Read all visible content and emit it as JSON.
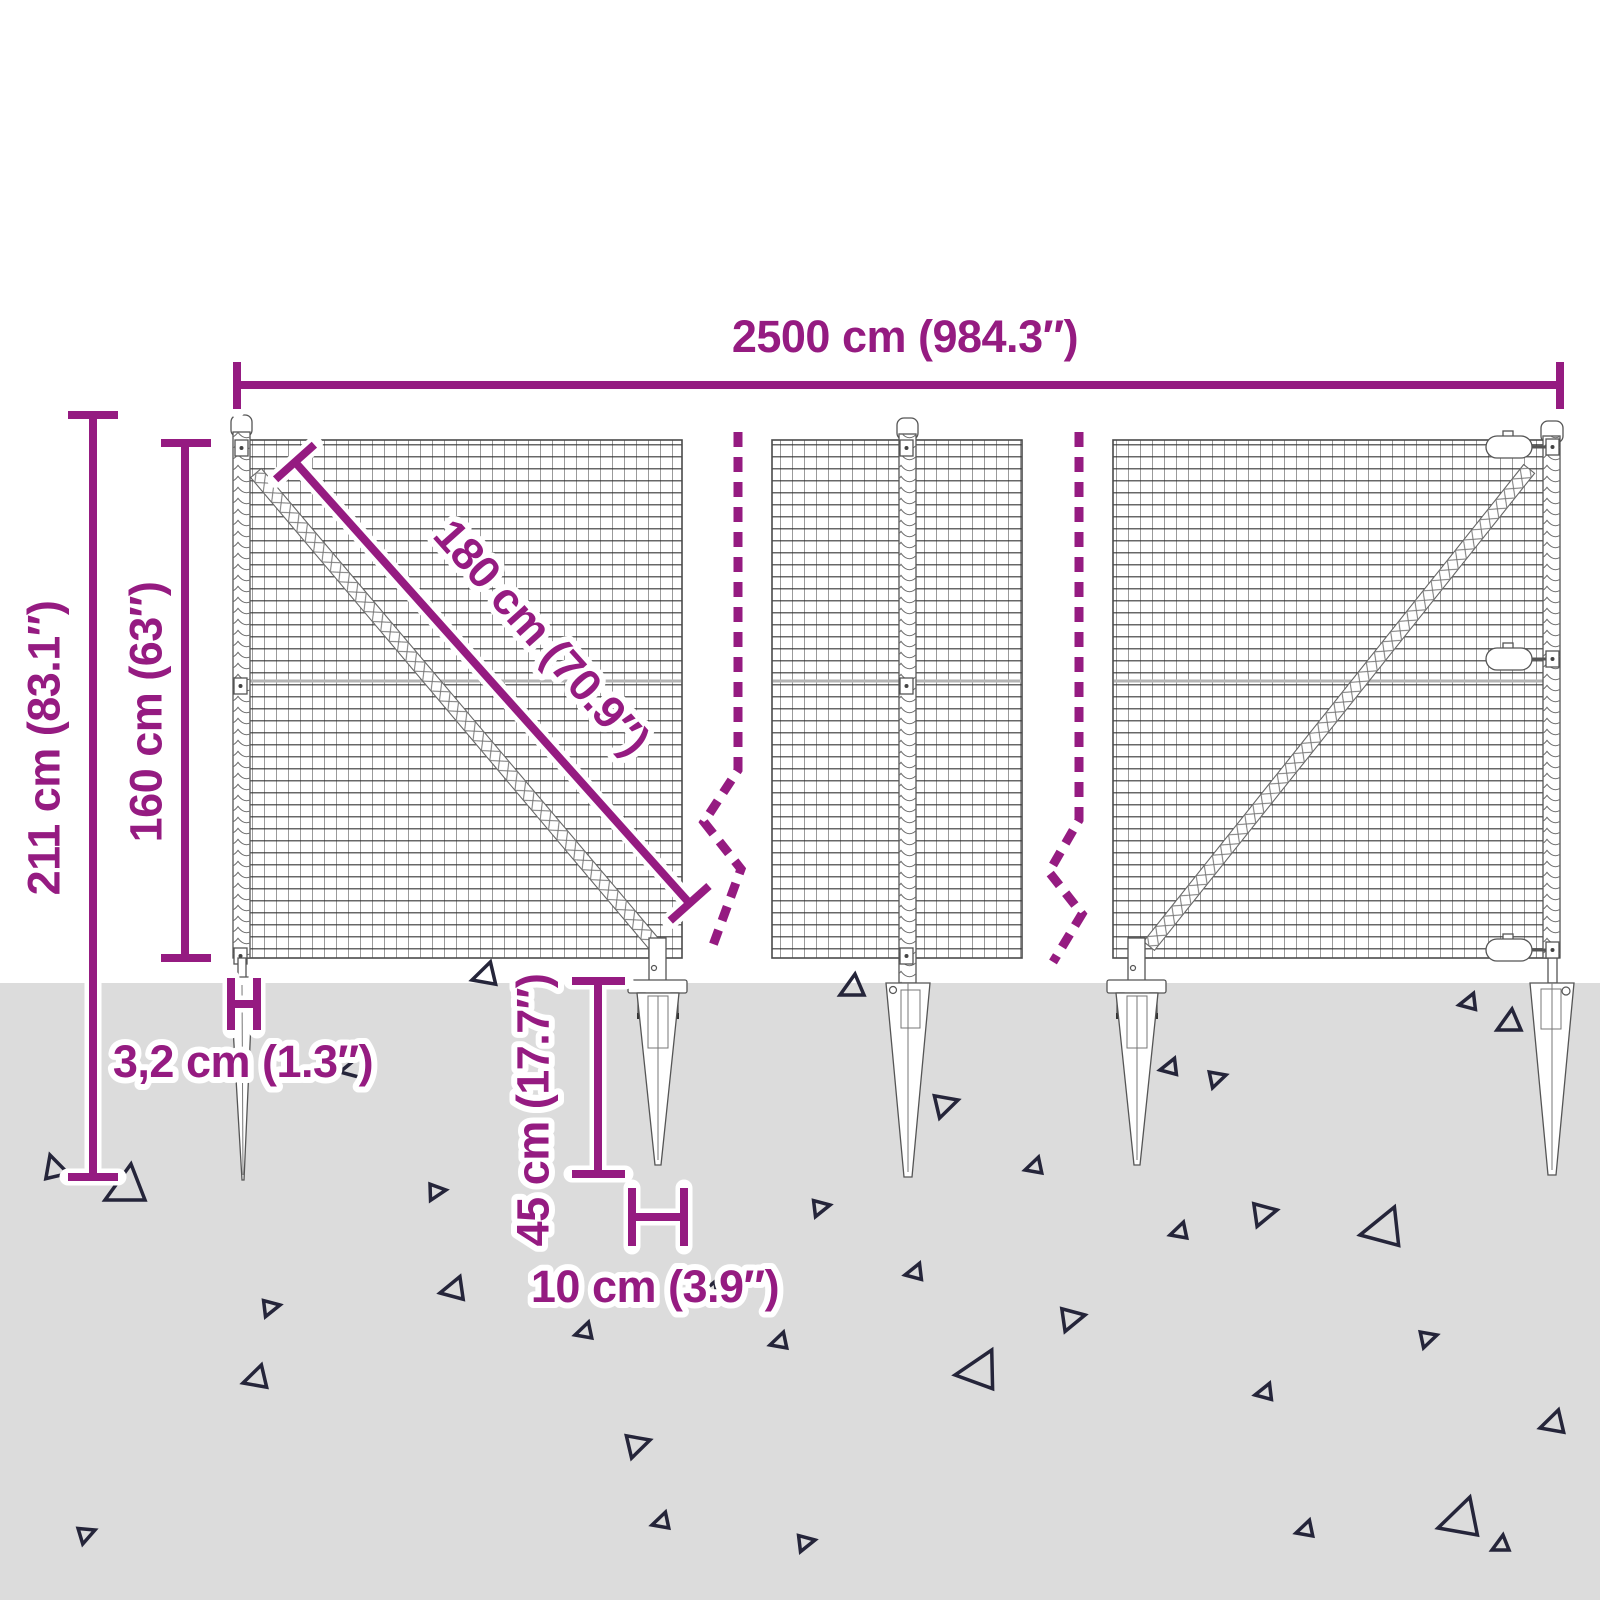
{
  "diagram": {
    "dimensions": {
      "total_width": "2500 cm (984.3″)",
      "total_height": "211 cm (83.1″)",
      "mesh_height": "160 cm (63″)",
      "diagonal": "180 cm (70.9″)",
      "post_width": "3,2 cm (1.3″)",
      "spike_depth": "45 cm (17.7″)",
      "spike_plate_width": "10 cm (3.9″)"
    },
    "colors": {
      "accent": "#951B81",
      "ground": "#DCDCDC",
      "line_art": "#555555",
      "background": "#FFFFFF"
    }
  }
}
